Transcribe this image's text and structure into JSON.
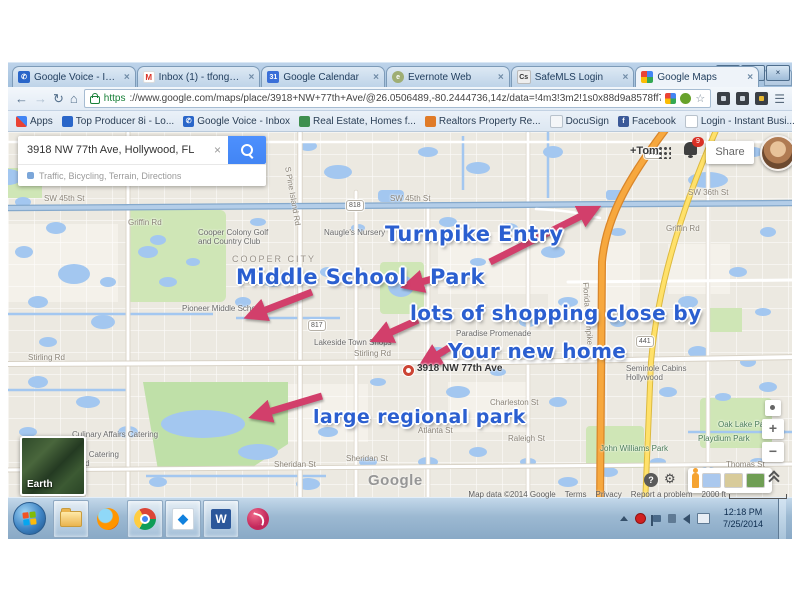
{
  "browser": {
    "tabs": [
      {
        "label": "Google Voice - Inbox"
      },
      {
        "label": "Inbox (1) - tfongolfer@g..."
      },
      {
        "label": "Google Calendar"
      },
      {
        "label": "Evernote Web"
      },
      {
        "label": "SafeMLS Login"
      },
      {
        "label": "Google Maps"
      }
    ],
    "url_scheme": "https",
    "url_rest": "://www.google.com/maps/place/3918+NW+77th+Ave/@26.0506489,-80.2444736,14z/data=!4m3!3m2!1s0x88d9a8578ff794f1:0xa287d65...",
    "bookmarks": [
      {
        "label": "Apps"
      },
      {
        "label": "Top Producer 8i - Lo..."
      },
      {
        "label": "Google Voice - Inbox"
      },
      {
        "label": "Real Estate, Homes f..."
      },
      {
        "label": "Realtors Property Re..."
      },
      {
        "label": "DocuSign"
      },
      {
        "label": "Facebook"
      },
      {
        "label": "Login - Instant Busi..."
      },
      {
        "label": "FUEL Lead System - ..."
      }
    ],
    "other_bookmarks": "Other bookmarks",
    "favicon_letters": {
      "gmail": "M",
      "safemls": "Cs",
      "facebook": "f",
      "calendar": "31",
      "voice": "GV"
    }
  },
  "icons": {
    "close": "×",
    "back": "←",
    "forward": "→",
    "reload": "↻",
    "home": "⌂",
    "menu": "☰",
    "star": "☆",
    "overflow": "»",
    "help": "?",
    "gear": "⚙",
    "plus": "+",
    "minus": "−",
    "minimize": "—",
    "maximize": "▢",
    "close_window": "×",
    "dropbox": "◆",
    "word": "W"
  },
  "map": {
    "search": {
      "value": "3918 NW 77th Ave, Hollywood, FL",
      "options": "Traffic, Bicycling, Terrain, Directions"
    },
    "user": {
      "plus_name": "+Tom",
      "share": "Share",
      "notification_count": "9"
    },
    "marker_label": "3918 NW 77th Ave",
    "earth_label": "Earth",
    "logo": "Google",
    "footer": {
      "map_data": "Map data ©2014 Google",
      "terms": "Terms",
      "privacy": "Privacy",
      "report": "Report a problem",
      "scale": "2000 ft"
    },
    "annotation_color": "#2b5fd0",
    "arrow_color": "#d23f6b",
    "annotations": [
      {
        "text": "Turnpike Entry",
        "x": 377,
        "y": 90,
        "size": 21
      },
      {
        "text": "Middle School",
        "x": 228,
        "y": 133,
        "size": 21
      },
      {
        "text": "Park",
        "x": 422,
        "y": 133,
        "size": 21
      },
      {
        "text": "lots of shopping close by",
        "x": 402,
        "y": 169,
        "size": 20
      },
      {
        "text": "Your new home",
        "x": 440,
        "y": 207,
        "size": 20
      },
      {
        "text": "large regional park",
        "x": 305,
        "y": 274,
        "size": 19
      }
    ],
    "arrows": [
      {
        "x1": 482,
        "y1": 130,
        "x2": 587,
        "y2": 77
      },
      {
        "x1": 304,
        "y1": 160,
        "x2": 242,
        "y2": 184
      },
      {
        "x1": 424,
        "y1": 147,
        "x2": 399,
        "y2": 154
      },
      {
        "x1": 410,
        "y1": 188,
        "x2": 368,
        "y2": 207
      },
      {
        "x1": 444,
        "y1": 214,
        "x2": 416,
        "y2": 231
      },
      {
        "x1": 314,
        "y1": 264,
        "x2": 247,
        "y2": 284
      }
    ],
    "labels": [
      {
        "t": "Nova Middle School",
        "x": 44,
        "y": 6,
        "c": "poi"
      },
      {
        "t": "SW 45th St",
        "x": 36,
        "y": 62,
        "c": "st"
      },
      {
        "t": "SW 45th St",
        "x": 382,
        "y": 62,
        "c": "st"
      },
      {
        "t": "Griffin Rd",
        "x": 120,
        "y": 86,
        "c": "st"
      },
      {
        "t": "Griffin Rd",
        "x": 658,
        "y": 92,
        "c": "st"
      },
      {
        "t": "SW 36th St",
        "x": 680,
        "y": 56,
        "c": "st"
      },
      {
        "t": "Cooper Colony Golf\nand Country Club",
        "x": 190,
        "y": 96,
        "c": "poi"
      },
      {
        "t": "COOPER CITY",
        "x": 224,
        "y": 122,
        "c": "city"
      },
      {
        "t": "Naugle's Nursery",
        "x": 316,
        "y": 96,
        "c": "poi"
      },
      {
        "t": "Pioneer Middle School",
        "x": 174,
        "y": 172,
        "c": "poi"
      },
      {
        "t": "Lakeside Town Shops",
        "x": 306,
        "y": 206,
        "c": "poi"
      },
      {
        "t": "Paradise Promenade",
        "x": 448,
        "y": 197,
        "c": "poi"
      },
      {
        "t": "Stirling Rd",
        "x": 20,
        "y": 221,
        "c": "st"
      },
      {
        "t": "Stirling Rd",
        "x": 346,
        "y": 217,
        "c": "st"
      },
      {
        "t": "Seminole Cabins\nHollywood",
        "x": 618,
        "y": 232,
        "c": "poi"
      },
      {
        "t": "Culinary Affairs Catering",
        "x": 64,
        "y": 298,
        "c": "poi"
      },
      {
        "t": "Stoddard Catering\nGroup Ltd",
        "x": 46,
        "y": 318,
        "c": "poi"
      },
      {
        "t": "Sheridan St",
        "x": 266,
        "y": 328,
        "c": "st"
      },
      {
        "t": "Sheridan St",
        "x": 338,
        "y": 322,
        "c": "st"
      },
      {
        "t": "Thomas St",
        "x": 718,
        "y": 328,
        "c": "st"
      },
      {
        "t": "Raleigh St",
        "x": 500,
        "y": 302,
        "c": "st"
      },
      {
        "t": "Atlanta St",
        "x": 410,
        "y": 294,
        "c": "st"
      },
      {
        "t": "Charleston St",
        "x": 482,
        "y": 266,
        "c": "st"
      },
      {
        "t": "John Williams Park",
        "x": 592,
        "y": 312,
        "c": "grn"
      },
      {
        "t": "Oak Lake Park",
        "x": 710,
        "y": 288,
        "c": "grn"
      },
      {
        "t": "Playdium Park",
        "x": 690,
        "y": 302,
        "c": "grn"
      },
      {
        "t": "S Pine Island Rd",
        "x": 284,
        "y": 34,
        "c": "st",
        "r": 80
      },
      {
        "t": "Florida's Turnpike",
        "x": 582,
        "y": 150,
        "c": "st",
        "r": 86
      },
      {
        "t": "818",
        "x": 338,
        "y": 68,
        "c": "shield"
      },
      {
        "t": "817",
        "x": 300,
        "y": 188,
        "c": "shield"
      },
      {
        "t": "441",
        "x": 636,
        "y": 16,
        "c": "shield"
      },
      {
        "t": "441",
        "x": 628,
        "y": 204,
        "c": "shield"
      }
    ]
  },
  "taskbar": {
    "clock_time": "12:18 PM",
    "clock_date": "7/25/2014"
  }
}
